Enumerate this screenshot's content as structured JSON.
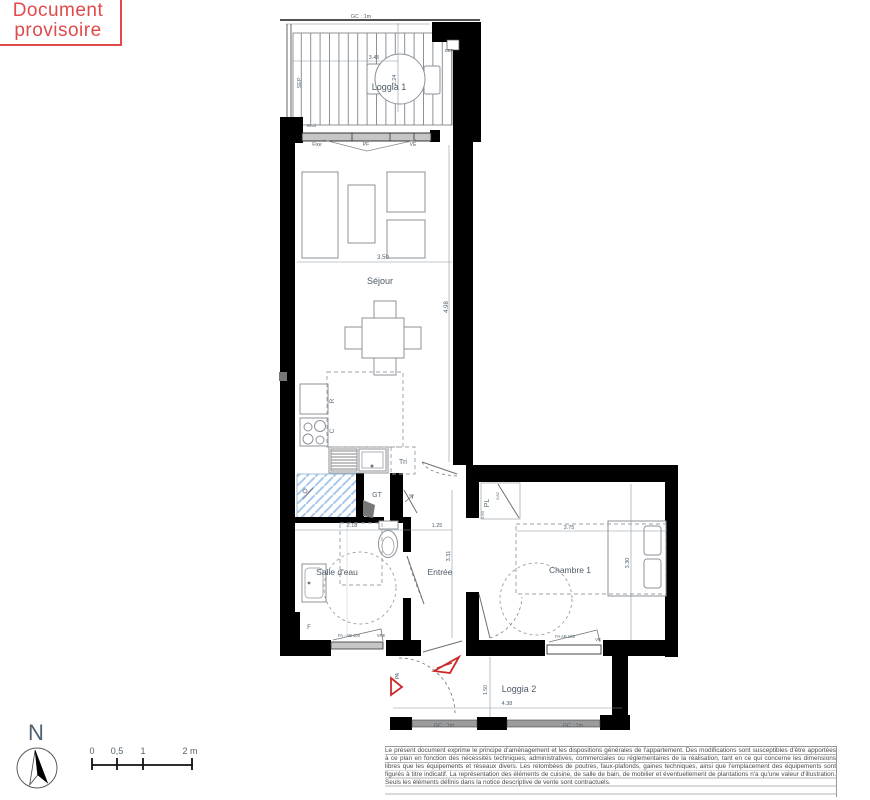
{
  "stamp": {
    "line1": "Document",
    "line2": "provisoire"
  },
  "colors": {
    "stamp_red": "#e04a4a",
    "wall_black": "#000000",
    "hatch_blue": "#a7c9ea",
    "arrow_red": "#cc2a2a",
    "dim_gray": "#51626e"
  },
  "plan": {
    "rooms": {
      "loggia1": "Loggia 1",
      "sejour": "Séjour",
      "salle_deau": "Salle d'eau",
      "entree": "Entrée",
      "chambre1": "Chambre 1",
      "loggia2": "Loggia 2"
    },
    "dims": {
      "loggia1_w": "3.45",
      "loggia1_d": "2.24",
      "sejour_w": "3.50",
      "sejour_h": "4.98",
      "sde_w": "2.18",
      "entree_w": "1.25",
      "entree_h": "3.31",
      "chambre_w": "3.75",
      "chambre_h": "3.30",
      "loggia2_w": "4.38",
      "loggia2_h": "1.50",
      "pl_w": "0.82",
      "pl_d": "0.60"
    },
    "codes": {
      "gc": "GC : 1m",
      "sep": "SEP",
      "dep": "DEP",
      "seuil": "Seuil",
      "fixe": "Fixe",
      "pf": "PF",
      "ve": "VE",
      "fridge": "R",
      "cook": "C",
      "tri": "Tri",
      "gt": "GT",
      "pl": "PL",
      "pa": "PA",
      "f": "F",
      "win_sde": "FA - AB 100",
      "vre": "VRE",
      "win_ch": "FA AB 105",
      "vr": "VR"
    }
  },
  "compass": {
    "n": "N"
  },
  "scalebar": {
    "zero": "0",
    "half": "0,5",
    "one": "1",
    "two": "2 m"
  },
  "disclaimer": "Le présent document exprime le principe d'aménagement et les dispositions générales de l'appartement. Des modifications sont susceptibles d'être apportées à ce plan en fonction des nécessités techniques, administratives, commerciales ou réglementaires de la réalisation, tant en ce qui concerne les dimensions libres que les équipements et réseaux divers. Les retombées de poutres, faux-plafonds, gaines techniques, ainsi que l'emplacement des équipements sont figurés à titre indicatif. La représentation des éléments de cuisine, de salle de bain, de mobilier et éventuellement de plantations n'a qu'une valeur d'illustration. Seuls les éléments définis dans la notice descriptive de vente sont contractuels."
}
